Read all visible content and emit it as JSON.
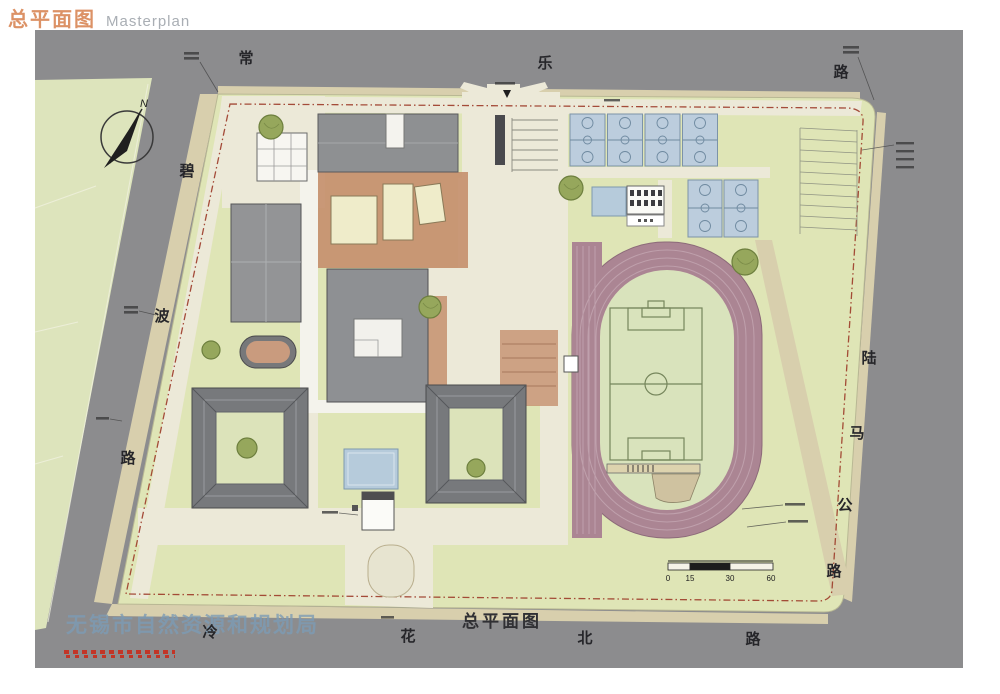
{
  "header": {
    "title_zh": "总平面图",
    "title_en": "Masterplan"
  },
  "roads": {
    "top": {
      "name": "常乐路",
      "chars": [
        "常",
        "乐",
        "路"
      ]
    },
    "left": {
      "name": "碧波路",
      "chars": [
        "碧",
        "波",
        "路"
      ]
    },
    "right": {
      "name": "陆马公路",
      "chars": [
        "陆",
        "马",
        "公",
        "路"
      ]
    },
    "bottom": {
      "name": "冷花北路",
      "chars": [
        "冷",
        "花",
        "北",
        "路"
      ]
    }
  },
  "labels": {
    "plan_caption": "总平面图"
  },
  "compass": {
    "label": "N"
  },
  "scale_bar": {
    "ticks": [
      "0",
      "15",
      "30",
      "60"
    ]
  },
  "watermark": {
    "agency": "无锡市自然资源和规划局"
  },
  "features": [
    "north-slab-building",
    "white-grid-building",
    "podium-terrace",
    "left-slab-building",
    "central-building",
    "southwest-courtyard-building",
    "southeast-courtyard-building",
    "swimming-pool",
    "south-gate",
    "running-track",
    "football-pitch",
    "basketball-courts",
    "parking-area",
    "long-jump-pit",
    "trees",
    "site-boundary"
  ],
  "colors": {
    "road_gray": "#8c8c8e",
    "site_green": "#dfe5b6",
    "sidewalk_tan": "#d8cfad",
    "path_cream": "#ece9d8",
    "building_gray": "#8e9092",
    "roof_dark": "#77797c",
    "terracotta": "#c6906f",
    "cream_building": "#efecca",
    "track_mauve": "#ab8593",
    "infield_green": "#d9e3bc",
    "court_blue": "#bccddd",
    "pool_blue": "#b6cbdb",
    "tree_olive": "#96a75c",
    "boundary_red": "#9c3a28",
    "title_orange": "#dc9266",
    "watermark_blue": "#7d9cb5",
    "stamp_red": "#c23527"
  }
}
